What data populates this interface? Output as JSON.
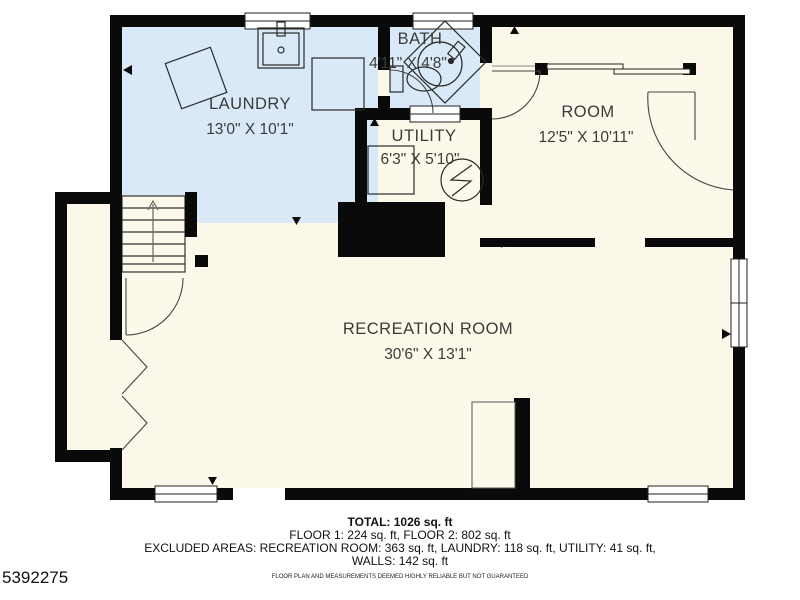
{
  "floor_plan": {
    "colors": {
      "wall": "#0a0a0a",
      "wet_room_fill": "#d9e9f7",
      "room_fill": "#fcf8ea",
      "outline": "#333333"
    },
    "rooms": [
      {
        "id": "laundry",
        "name": "LAUNDRY",
        "dimensions": "13'0\" X 10'1\""
      },
      {
        "id": "bath",
        "name": "BATH",
        "dimensions": "4'11\" X 4'8\""
      },
      {
        "id": "utility",
        "name": "UTILITY",
        "dimensions": "6'3\" X 5'10\""
      },
      {
        "id": "room",
        "name": "ROOM",
        "dimensions": "12'5\" X 10'11\""
      },
      {
        "id": "recreation_room",
        "name": "RECREATION ROOM",
        "dimensions": "30'6\" X 13'1\""
      }
    ],
    "fixtures": [
      "washer-icon",
      "laundry-sink-icon",
      "dryer-icon",
      "shower-icon",
      "toilet-icon",
      "water-heater-icon",
      "furnace-icon",
      "staircase-icon"
    ]
  },
  "summary": {
    "total": "TOTAL: 1026 sq. ft",
    "floors": "FLOOR 1: 224 sq. ft, FLOOR 2: 802 sq. ft",
    "excluded": "EXCLUDED AREAS: RECREATION ROOM: 363 sq. ft, LAUNDRY: 118 sq. ft, UTILITY: 41 sq. ft,",
    "walls": "WALLS: 142 sq. ft",
    "disclaimer": "FLOOR PLAN AND MEASUREMENTS DEEMED HIGHLY RELIABLE BUT NOT GUARANTEED"
  },
  "listing_id": "5392275"
}
